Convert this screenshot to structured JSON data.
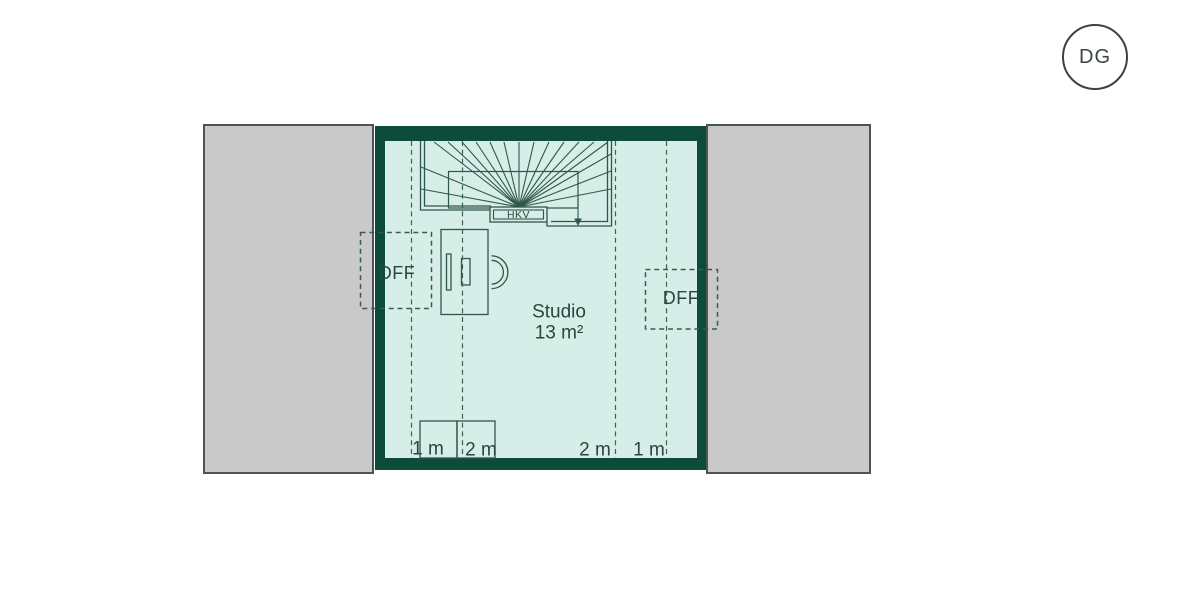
{
  "badge": {
    "label": "DG"
  },
  "room": {
    "name": "Studio",
    "area": "13 m²"
  },
  "stair": {
    "distribution_box_label": "HKV"
  },
  "roof_windows": {
    "left": "DFF",
    "right": "DFF"
  },
  "roof_height_lines": [
    {
      "label": "1 m"
    },
    {
      "label": "2 m"
    },
    {
      "label": "2 m"
    },
    {
      "label": "1 m"
    }
  ],
  "colors": {
    "wall": "#0d4b3a",
    "floor": "#d6eee7",
    "roof_area": "#c8c9c8",
    "line": "#30564b",
    "dash_line": "#3f6156",
    "text": "#2a453e"
  }
}
